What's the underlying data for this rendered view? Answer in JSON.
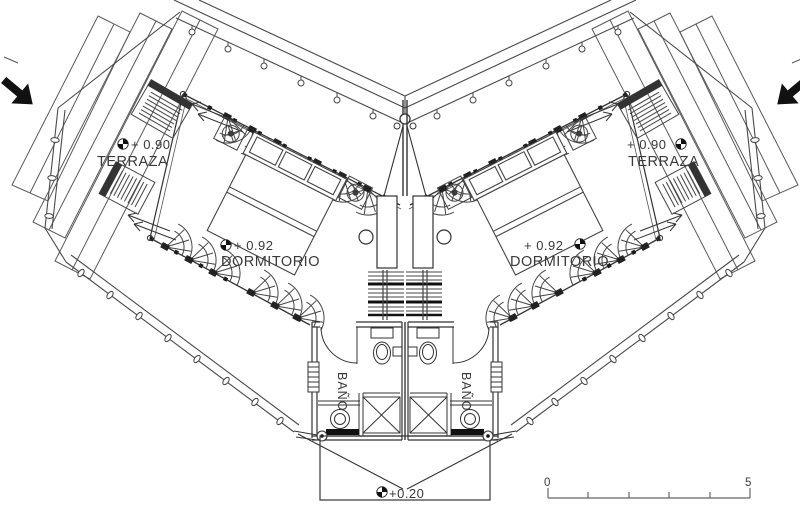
{
  "plan": {
    "left_wing": {
      "terrace_level": "+ 0.90",
      "terrace_label": "TERRAZA",
      "bedroom_level": "+ 0.92",
      "bedroom_label": "DORMITORIO",
      "bath_label": "BAÑO"
    },
    "right_wing": {
      "terrace_level": "+ 0.90",
      "terrace_label": "TERRAZA",
      "bedroom_level": "+ 0.92",
      "bedroom_label": "DORMITORIO",
      "bath_label": "BAÑO"
    },
    "entry_level": "+0.20",
    "scale_bar": {
      "start_label": "0",
      "end_label": "5"
    },
    "symbols": {
      "level_marker": "quadrant-circle-level-marker",
      "entry_direction": "solid-black-arrow"
    },
    "colors": {
      "ink": "#3a3a3a",
      "paper": "#ffffff"
    }
  }
}
